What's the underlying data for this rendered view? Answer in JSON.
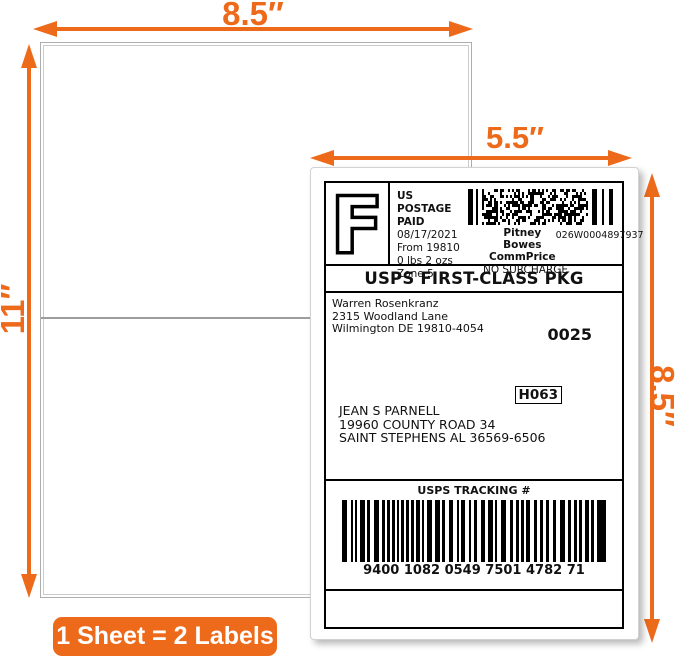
{
  "colors": {
    "accent": "#ed6a1a"
  },
  "dimensions": {
    "sheet_width": "8.5″",
    "sheet_height": "11″",
    "label_width": "5.5″",
    "label_height": "8.5″"
  },
  "badge": {
    "text": "1 Sheet = 2 Labels"
  },
  "shipping_label": {
    "indicia": {
      "letter": "F",
      "postage_paid": "US POSTAGE PAID",
      "date": "08/17/2021",
      "from": "From 19810",
      "weight": "0 lbs 2 ozs",
      "zone": "Zone 5",
      "carrier": "Pitney Bowes",
      "rate": "CommPrice",
      "meter_number": "026W0004897937",
      "surcharge": "NO SURCHARGE"
    },
    "service": "USPS FIRST-CLASS PKG",
    "sender": {
      "name": "Warren Rosenkranz",
      "street": "2315 Woodland Lane",
      "city_line": "Wilmington DE 19810-4054"
    },
    "batch_number": "0025",
    "sort_code": "H063",
    "recipient": {
      "name": "JEAN S PARNELL",
      "street": "19960 COUNTY ROAD 34",
      "city_line": "SAINT STEPHENS AL 36569-6506"
    },
    "tracking": {
      "header": "USPS TRACKING #",
      "number": "9400 1082 0549 7501 4782 71"
    }
  }
}
